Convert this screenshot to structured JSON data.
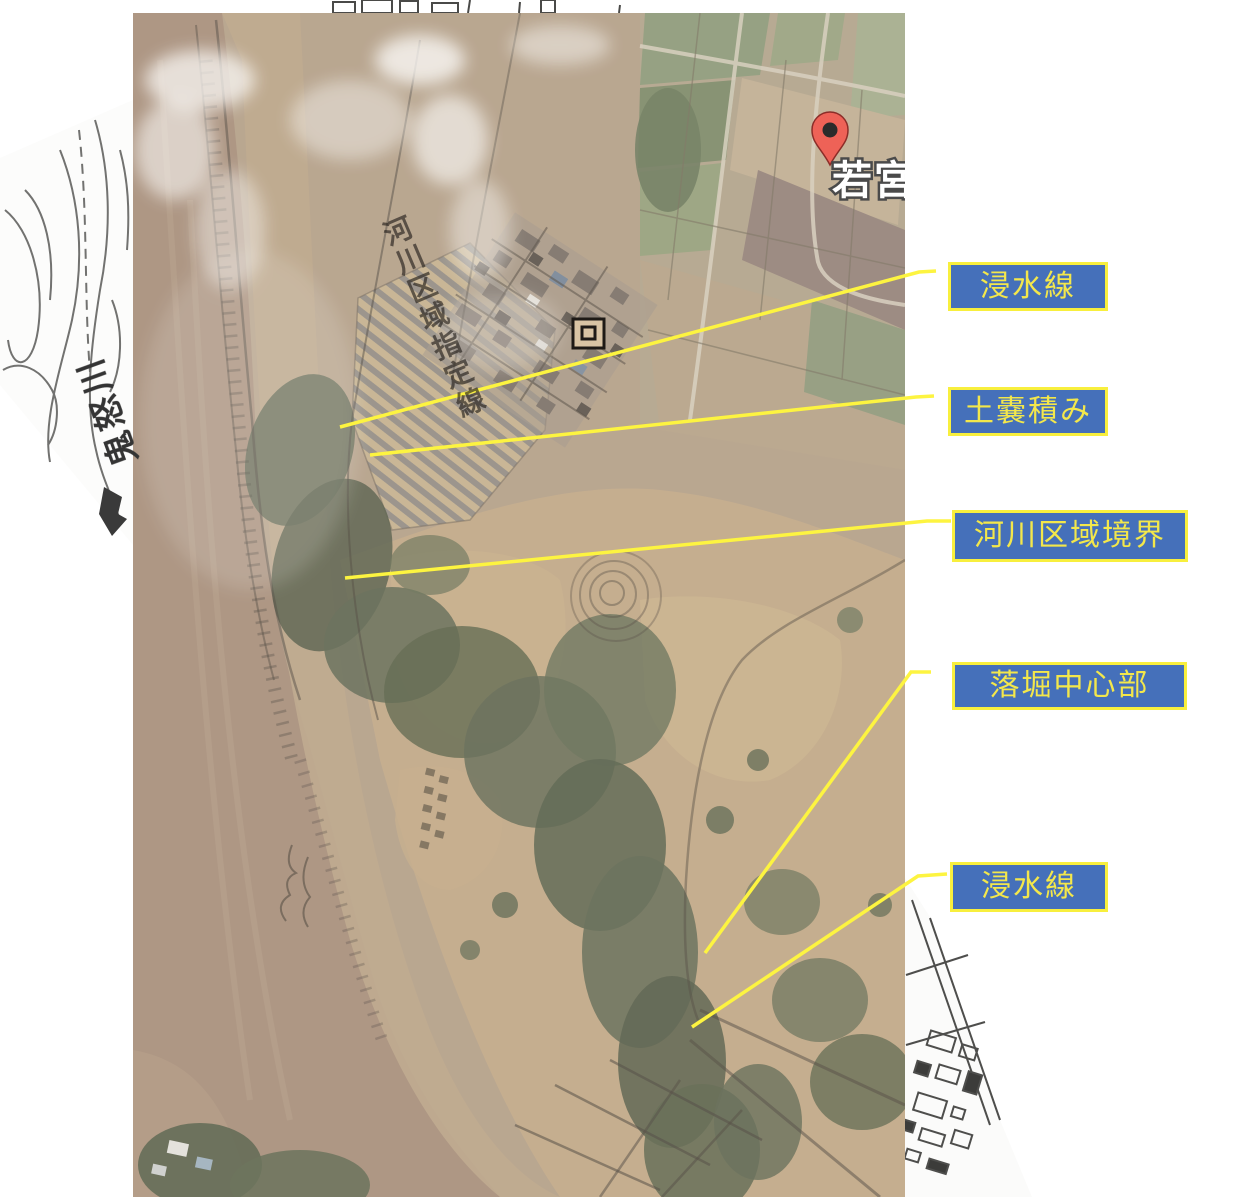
{
  "figure": {
    "description_labels": [
      {
        "id": "flood-line-top",
        "text": "浸水線"
      },
      {
        "id": "sandbag-stack",
        "text": "土嚢積み"
      },
      {
        "id": "river-area-border",
        "text": "河川区域境界"
      },
      {
        "id": "scour-pit-center",
        "text": "落堀中心部"
      },
      {
        "id": "flood-line-bottom",
        "text": "浸水線"
      }
    ],
    "label_style": {
      "background": "#4570ba",
      "border": "#f8ef3d",
      "text_color": "#f3e74b"
    },
    "callout_line_color": "#fdf440",
    "map_pin": {
      "label": "若宮戸",
      "pin_color": "#ee6257"
    },
    "base_map_texts": {
      "river_name": "鬼怒川",
      "designation_line": "河川区域指定線"
    }
  }
}
